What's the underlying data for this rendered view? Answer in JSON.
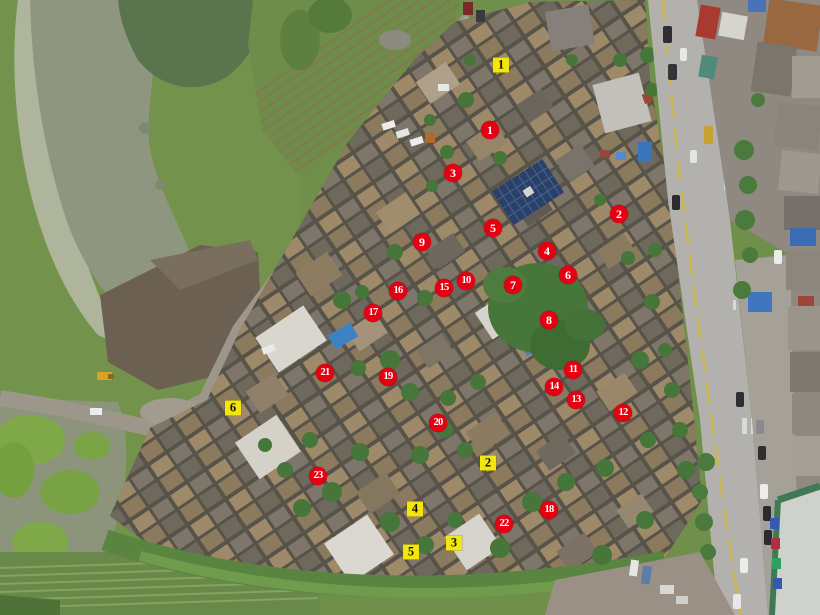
{
  "image": {
    "kind": "aerial-drone-orthophoto",
    "width": 820,
    "height": 615,
    "regions": [
      "fish-pond",
      "vegetable-plots",
      "village-rooftops",
      "tree-clusters",
      "main-road",
      "roadside-buildings",
      "excavated-ground",
      "bottom-farmland"
    ]
  },
  "marker_styles": {
    "red_circle": {
      "shape": "circle",
      "fill": "#e60012",
      "text_color": "#ffffff"
    },
    "yellow_square": {
      "shape": "square",
      "fill": "#f2e60c",
      "text_color": "#121200"
    }
  },
  "markers": {
    "red_circles": [
      {
        "label": "1",
        "x": 490,
        "y": 130
      },
      {
        "label": "2",
        "x": 619,
        "y": 214
      },
      {
        "label": "3",
        "x": 453,
        "y": 173
      },
      {
        "label": "4",
        "x": 547,
        "y": 251
      },
      {
        "label": "5",
        "x": 493,
        "y": 228
      },
      {
        "label": "6",
        "x": 568,
        "y": 275
      },
      {
        "label": "7",
        "x": 513,
        "y": 285
      },
      {
        "label": "8",
        "x": 549,
        "y": 320
      },
      {
        "label": "9",
        "x": 422,
        "y": 242
      },
      {
        "label": "10",
        "x": 466,
        "y": 281
      },
      {
        "label": "11",
        "x": 573,
        "y": 370
      },
      {
        "label": "12",
        "x": 623,
        "y": 413
      },
      {
        "label": "13",
        "x": 576,
        "y": 400
      },
      {
        "label": "14",
        "x": 554,
        "y": 387
      },
      {
        "label": "15",
        "x": 444,
        "y": 288
      },
      {
        "label": "16",
        "x": 398,
        "y": 291
      },
      {
        "label": "17",
        "x": 373,
        "y": 313
      },
      {
        "label": "18",
        "x": 549,
        "y": 510
      },
      {
        "label": "19",
        "x": 388,
        "y": 377
      },
      {
        "label": "20",
        "x": 438,
        "y": 423
      },
      {
        "label": "21",
        "x": 325,
        "y": 373
      },
      {
        "label": "22",
        "x": 504,
        "y": 524
      },
      {
        "label": "23",
        "x": 318,
        "y": 476
      }
    ],
    "yellow_squares": [
      {
        "label": "1",
        "x": 501,
        "y": 65
      },
      {
        "label": "2",
        "x": 488,
        "y": 463
      },
      {
        "label": "3",
        "x": 454,
        "y": 543
      },
      {
        "label": "4",
        "x": 415,
        "y": 509
      },
      {
        "label": "5",
        "x": 411,
        "y": 552
      },
      {
        "label": "6",
        "x": 233,
        "y": 408
      }
    ]
  }
}
